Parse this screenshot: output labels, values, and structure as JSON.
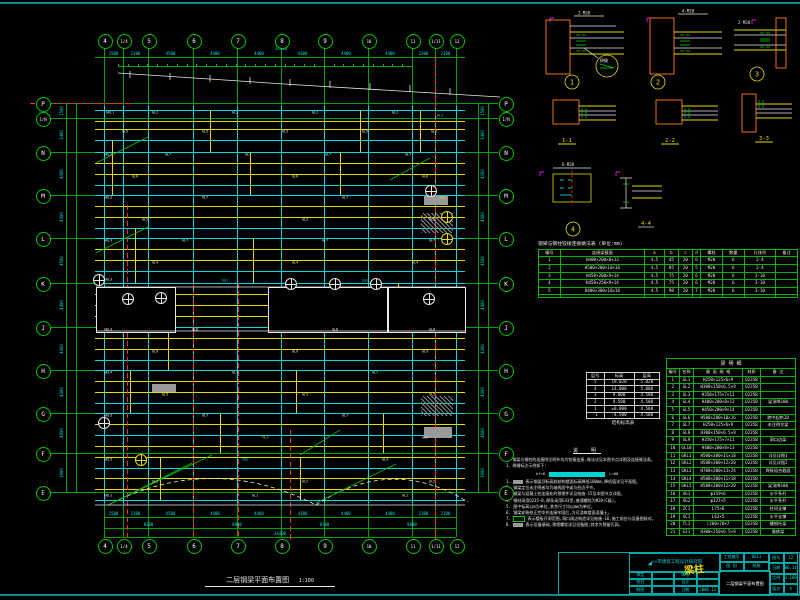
{
  "colors": {
    "green": "#00c000",
    "cyan": "#00dcdc",
    "yellow": "#e8d900",
    "red": "#ff2a2a",
    "white": "#e8e8e8",
    "orange": "#ff7f1f",
    "magenta": "#ff00ff",
    "grey": "#9a9a9a",
    "teal": "#0a8c8c"
  },
  "plan": {
    "title": "二层钢梁平面布置图",
    "scale": "1:100",
    "cols": [
      [
        "4",
        104
      ],
      [
        "1/4",
        123
      ],
      [
        "5",
        148
      ],
      [
        "6",
        193
      ],
      [
        "7",
        237
      ],
      [
        "8",
        281
      ],
      [
        "9",
        324
      ],
      [
        "10",
        368
      ],
      [
        "11",
        412
      ],
      [
        "1/11",
        435
      ],
      [
        "12",
        456
      ]
    ],
    "rows": [
      [
        "P",
        103
      ],
      [
        "1/N",
        118
      ],
      [
        "N",
        152
      ],
      [
        "M",
        195
      ],
      [
        "L",
        238
      ],
      [
        "K",
        283
      ],
      [
        "J",
        327
      ],
      [
        "H",
        370
      ],
      [
        "G",
        413
      ],
      [
        "F",
        453
      ],
      [
        "E",
        492
      ]
    ],
    "bubble_top_y": 40,
    "bubble_bot_y": 545,
    "left_bubble_x": 42,
    "right_bubble_x": 505,
    "beams": [
      [
        110,
        "c"
      ],
      [
        121,
        "y"
      ],
      [
        129,
        "y"
      ],
      [
        140,
        "c"
      ],
      [
        152,
        "c"
      ],
      [
        163,
        "y"
      ],
      [
        174,
        "y"
      ],
      [
        185,
        "c"
      ],
      [
        195,
        "c"
      ],
      [
        206,
        "y"
      ],
      [
        217,
        "y"
      ],
      [
        228,
        "c"
      ],
      [
        238,
        "c"
      ],
      [
        249,
        "y"
      ],
      [
        260,
        "y"
      ],
      [
        271,
        "c"
      ],
      [
        283,
        "c"
      ],
      [
        294,
        "y"
      ],
      [
        305,
        "y"
      ],
      [
        316,
        "y"
      ],
      [
        327,
        "c"
      ],
      [
        338,
        "y"
      ],
      [
        349,
        "y"
      ],
      [
        360,
        "c"
      ],
      [
        370,
        "c"
      ],
      [
        381,
        "y"
      ],
      [
        392,
        "y"
      ],
      [
        403,
        "c"
      ],
      [
        413,
        "c"
      ],
      [
        424,
        "y"
      ],
      [
        435,
        "c"
      ],
      [
        446,
        "y"
      ],
      [
        457,
        "y"
      ],
      [
        468,
        "c"
      ],
      [
        478,
        "y"
      ],
      [
        489,
        "y"
      ],
      [
        500,
        "c"
      ]
    ],
    "yellow_v": [
      [
        112,
        140,
        195
      ],
      [
        135,
        228,
        283
      ],
      [
        168,
        327,
        370
      ],
      [
        210,
        110,
        152
      ],
      [
        253,
        238,
        283
      ],
      [
        296,
        370,
        413
      ],
      [
        340,
        152,
        195
      ],
      [
        383,
        413,
        453
      ],
      [
        398,
        283,
        327
      ],
      [
        420,
        110,
        152
      ],
      [
        160,
        457,
        500
      ],
      [
        220,
        413,
        453
      ],
      [
        300,
        457,
        500
      ],
      [
        360,
        110,
        152
      ],
      [
        250,
        152,
        195
      ],
      [
        130,
        370,
        413
      ]
    ],
    "labels": [
      [
        "GKL1",
        110,
        113,
        "w"
      ],
      [
        "GL2",
        155,
        113,
        "w"
      ],
      [
        "GL2",
        235,
        113,
        "w"
      ],
      [
        "GL2",
        315,
        113,
        "w"
      ],
      [
        "GL2",
        395,
        113,
        "w"
      ],
      [
        "GL3",
        440,
        116,
        "c"
      ],
      [
        "GL5",
        125,
        132,
        "w"
      ],
      [
        "GL5",
        205,
        132,
        "w"
      ],
      [
        "GL5",
        285,
        132,
        "w"
      ],
      [
        "GL5",
        365,
        132,
        "w"
      ],
      [
        "GL3",
        434,
        132,
        "w"
      ],
      [
        "GKL2",
        108,
        155,
        "w"
      ],
      [
        "GL7",
        168,
        155,
        "w"
      ],
      [
        "GL7",
        248,
        155,
        "w"
      ],
      [
        "GL7",
        328,
        155,
        "w"
      ],
      [
        "GL7",
        408,
        155,
        "w"
      ],
      [
        "GL6",
        135,
        177,
        "w"
      ],
      [
        "GL6",
        295,
        177,
        "w"
      ],
      [
        "GL6",
        425,
        177,
        "w"
      ],
      [
        "GKL2",
        108,
        198,
        "w"
      ],
      [
        "GL7",
        205,
        198,
        "w"
      ],
      [
        "GL7",
        345,
        198,
        "w"
      ],
      [
        "B1",
        443,
        198,
        "y"
      ],
      [
        "GL5",
        145,
        220,
        "w"
      ],
      [
        "GL5",
        305,
        220,
        "w"
      ],
      [
        "GL5",
        432,
        220,
        "w"
      ],
      [
        "GKL3",
        108,
        241,
        "w"
      ],
      [
        "GL7",
        185,
        241,
        "w"
      ],
      [
        "GL7",
        325,
        241,
        "w"
      ],
      [
        "GL7",
        432,
        241,
        "w"
      ],
      [
        "GL4",
        155,
        263,
        "w"
      ],
      [
        "GL4",
        295,
        263,
        "w"
      ],
      [
        "GL4",
        415,
        263,
        "w"
      ],
      [
        "GKL3",
        108,
        280,
        "w"
      ],
      [
        "XG1",
        225,
        281,
        "c"
      ],
      [
        "XG1",
        365,
        281,
        "c"
      ],
      [
        "GKL4",
        108,
        330,
        "w"
      ],
      [
        "GL8",
        195,
        330,
        "w"
      ],
      [
        "GL8",
        335,
        330,
        "w"
      ],
      [
        "GL8",
        432,
        330,
        "w"
      ],
      [
        "GL9",
        155,
        352,
        "w"
      ],
      [
        "GL9",
        295,
        352,
        "w"
      ],
      [
        "GL9",
        425,
        352,
        "w"
      ],
      [
        "GKL4",
        108,
        373,
        "w"
      ],
      [
        "GL7",
        235,
        373,
        "w"
      ],
      [
        "GL7",
        375,
        373,
        "w"
      ],
      [
        "GL5",
        165,
        395,
        "w"
      ],
      [
        "GL5",
        305,
        395,
        "w"
      ],
      [
        "GL5",
        432,
        395,
        "w"
      ],
      [
        "GKL5",
        108,
        416,
        "w"
      ],
      [
        "GL7",
        205,
        416,
        "w"
      ],
      [
        "GL7",
        345,
        416,
        "w"
      ],
      [
        "TL1",
        265,
        438,
        "y"
      ],
      [
        "GJ1",
        425,
        438,
        "w"
      ],
      [
        "GKL5",
        108,
        460,
        "w"
      ],
      [
        "XG2",
        245,
        460,
        "c"
      ],
      [
        "GL3",
        385,
        460,
        "w"
      ],
      [
        "GL2",
        155,
        482,
        "w"
      ],
      [
        "GL2",
        305,
        482,
        "w"
      ],
      [
        "GL2",
        432,
        482,
        "w"
      ],
      [
        "GKL1",
        108,
        496,
        "w"
      ],
      [
        "GL1",
        255,
        496,
        "w"
      ],
      [
        "GL1",
        405,
        496,
        "w"
      ]
    ],
    "dims_top": [
      "1500",
      "2100",
      "4500",
      "4400",
      "4400",
      "4300",
      "4400",
      "4400",
      "2300",
      "2100"
    ],
    "total_top": "34400",
    "dims_bottom": [
      "1500",
      "2100",
      "4500",
      "4400",
      "4400",
      "4300",
      "4400",
      "4400",
      "2300",
      "2100"
    ],
    "dims_bottom2": [
      [
        "8100",
        104,
        193
      ],
      [
        "8800",
        193,
        281
      ],
      [
        "8700",
        281,
        368
      ],
      [
        "8800",
        368,
        456
      ]
    ],
    "total_bottom": "34400",
    "dims_left": [
      "1500",
      "3400",
      "4300",
      "4300",
      "4500",
      "4400",
      "4300",
      "4300",
      "4000",
      "3900"
    ],
    "dims_right": [
      "1500",
      "3400",
      "4300",
      "4300",
      "4500",
      "4400",
      "4300",
      "4300",
      "4000",
      "3900"
    ],
    "dim_lines_h": [
      [
        57,
        95,
        465
      ],
      [
        66,
        118,
        412
      ],
      [
        517,
        104,
        456
      ],
      [
        528,
        104,
        456
      ],
      [
        537,
        104,
        456
      ]
    ],
    "dim_lines_v": [
      [
        66,
        103,
        492
      ],
      [
        76,
        103,
        492
      ],
      [
        478,
        103,
        492
      ],
      [
        488,
        103,
        492
      ]
    ],
    "tick_row": {
      "y": 64,
      "x1": 118,
      "x2": 412,
      "step": 9.8
    },
    "red_v": [
      [
        127,
        205,
        540
      ],
      [
        193,
        283,
        540
      ],
      [
        238,
        283,
        540
      ],
      [
        290,
        430,
        540
      ],
      [
        435,
        55,
        540
      ]
    ],
    "red_h": [
      [
        103,
        30,
        133
      ]
    ],
    "openings": [
      [
        96,
        287,
        78,
        44
      ],
      [
        268,
        287,
        118,
        44
      ],
      [
        388,
        287,
        76,
        44
      ]
    ],
    "grey": [
      [
        424,
        196,
        24,
        9
      ],
      [
        424,
        427,
        28,
        11
      ],
      [
        152,
        384,
        24,
        8
      ]
    ],
    "hatch": [
      [
        421,
        213,
        32,
        20
      ],
      [
        421,
        396,
        32,
        20
      ]
    ],
    "symbols": [
      [
        98,
        279,
        "w"
      ],
      [
        127,
        298,
        "w"
      ],
      [
        160,
        297,
        "w"
      ],
      [
        290,
        283,
        "w"
      ],
      [
        334,
        283,
        "w"
      ],
      [
        375,
        283,
        "w"
      ],
      [
        428,
        298,
        "w"
      ],
      [
        430,
        190,
        "w"
      ],
      [
        446,
        216,
        "y"
      ],
      [
        446,
        238,
        "y"
      ],
      [
        103,
        422,
        "w"
      ],
      [
        140,
        459,
        "y"
      ]
    ],
    "paths": [
      [
        "M118,73 L300,85 L500,97",
        "w",
        ""
      ],
      [
        "M130,71 L130,78 M170,73 L170,80 M210,75 L210,82 M250,77 L250,84 M290,79 L290,86 M330,81 L330,88 M370,83 L370,90 M410,85 L410,92 M450,88 L450,95",
        "w",
        ""
      ],
      [
        "M108,505 Q212,452 316,505",
        "w",
        "4,3"
      ],
      [
        "M316,505 Q392,455 468,502",
        "w",
        "4,3"
      ],
      [
        "M112,503 L192,463",
        "g",
        ""
      ],
      [
        "M212,455 L108,505",
        "g",
        ""
      ],
      [
        "M316,503 L396,464",
        "g",
        ""
      ],
      [
        "M96,287 L465,287",
        "w",
        ""
      ],
      [
        "M96,331 L465,331",
        "w",
        ""
      ],
      [
        "M95,505 L465,505",
        "w",
        ""
      ],
      [
        "M96,163 L148,137",
        "g",
        ""
      ],
      [
        "M96,253 L148,227",
        "g",
        ""
      ],
      [
        "M390,180 L430,158",
        "g",
        ""
      ],
      [
        "M300,455 L340,430",
        "g",
        ""
      ]
    ]
  },
  "details": {
    "d1": {
      "num": "1",
      "sec": "1-1",
      "ann1": "2-M20",
      "ann2": "PL-10"
    },
    "d2": {
      "num": "2",
      "sec": "2-2",
      "ann1": "4-M20",
      "ann2": "PL-12"
    },
    "d3": {
      "num": "3",
      "sec": "3-3",
      "ann1": "2-M20",
      "ann2": "PL-10"
    },
    "d4": {
      "num": "4",
      "sec": "4-4",
      "ann1": "6-M20",
      "ann2": "PL-12"
    },
    "callout": "焊缝"
  },
  "conn_table": {
    "title": "钢梁与钢柱铰接连接做法表 (单位:mm)",
    "headers": [
      "编号",
      "连接梁截面",
      "a",
      "b",
      "c",
      "d",
      "螺栓",
      "数量",
      "孔排列",
      "备注"
    ],
    "rows": [
      [
        "1",
        "H400×200×8×13",
        "4.5",
        "45",
        "20",
        "6",
        "M20",
        "6",
        "2-4",
        ""
      ],
      [
        "2",
        "H500×200×10×16",
        "4.5",
        "85",
        "20",
        "5",
        "M20",
        "6",
        "2-4",
        ""
      ],
      [
        "3",
        "H450×200×9×14",
        "4.5",
        "75",
        "20",
        "6",
        "M20",
        "6",
        "3-10",
        ""
      ],
      [
        "4",
        "H450×250×9×14",
        "4.5",
        "75",
        "20",
        "6",
        "M20",
        "6",
        "3-10",
        ""
      ],
      [
        "5",
        "H400×300×10×16",
        "4.5",
        "90",
        "20",
        "7",
        "M20",
        "6",
        "3-10",
        ""
      ],
      [
        "",
        "",
        "",
        "",
        "",
        "",
        "",
        "",
        "",
        ""
      ]
    ]
  },
  "level_table": {
    "headers": [
      "层号",
      "标高",
      "层高"
    ],
    "rows": [
      [
        "5",
        "19.020",
        "5.020"
      ],
      [
        "4",
        "14.000",
        "5.000"
      ],
      [
        "3",
        "9.000",
        "4.500"
      ],
      [
        "2",
        "4.500",
        "4.500"
      ],
      [
        "1",
        "±0.000",
        "4.500"
      ],
      [
        "-1",
        "-4.500",
        "4.500"
      ]
    ],
    "caption": "结构标高表"
  },
  "member_table": {
    "title": "梁  明  细",
    "headers": [
      "编号",
      "名称",
      "截 面 规 格",
      "材质",
      "备 注"
    ],
    "rows": [
      [
        "1",
        "GL1",
        "H250×125×6×9",
        "Q235B",
        ""
      ],
      [
        "2",
        "GL2",
        "H300×150×6.5×9",
        "Q235B",
        ""
      ],
      [
        "3",
        "GL3",
        "H350×175×7×11",
        "Q235B",
        ""
      ],
      [
        "4",
        "GL4",
        "H400×200×8×13",
        "Q235B",
        "梁顶降100"
      ],
      [
        "5",
        "GL5",
        "H450×200×9×14",
        "Q235B",
        ""
      ],
      [
        "6",
        "GL6",
        "H500×200×10×16",
        "Q235B",
        "跨中起拱20"
      ],
      [
        "7",
        "GL7",
        "H250×125×6×9",
        "Q235B",
        "未注明次梁"
      ],
      [
        "8",
        "GL8",
        "H300×150×6.5×9",
        "Q235B",
        ""
      ],
      [
        "9",
        "GL9",
        "H350×175×7×11",
        "Q235B",
        "洞口边梁"
      ],
      [
        "10",
        "GL10",
        "H400×200×8×13",
        "Q235B",
        ""
      ],
      [
        "11",
        "GKL1",
        "H500×300×11×18",
        "Q235B",
        "详见详图1"
      ],
      [
        "12",
        "GKL2",
        "H588×300×12×20",
        "Q235B",
        "详见详图2"
      ],
      [
        "13",
        "GKL3",
        "H700×300×13×24",
        "Q235B",
        "焊接组合截面"
      ],
      [
        "14",
        "GKL4",
        "H500×300×11×18",
        "Q235B",
        ""
      ],
      [
        "15",
        "GKL5",
        "H588×300×12×20",
        "Q235B",
        "梁顶降100"
      ],
      [
        "16",
        "XG1",
        "φ159×6",
        "Q235B",
        "水平系杆"
      ],
      [
        "17",
        "XG2",
        "φ127×5",
        "Q235B",
        "水平系杆"
      ],
      [
        "18",
        "ZC1",
        "L75×6",
        "Q235B",
        "柱间支撑"
      ],
      [
        "19",
        "SC1",
        "L63×5",
        "Q235B",
        "水平支撑"
      ],
      [
        "20",
        "TL1",
        "[200×70×7",
        "Q235B",
        "槽钢托梁"
      ],
      [
        "21",
        "GJ1",
        "H300×150×6.5×9",
        "Q235B",
        "悬挑梁"
      ]
    ]
  },
  "notes": {
    "header": "说  明",
    "intro": [
      "1、钢梁与钢柱的连接除注明外均为铰接连接,做法详见本图节点详图及连接做法表。",
      "2、焊缝标注示例如下:"
    ],
    "weld_left": "hf=6",
    "weld_right": "L=60",
    "items": [
      {
        "n": "1.",
        "box": "grey",
        "t": "表示钢梁顶标高较结构楼面标高降低100mm,降低值详见平面图。"
      },
      {
        "n": "2.",
        "box": "",
        "t": "钢梁定位未注明者均为轴线居中或与柱边平齐。"
      },
      {
        "n": "3.",
        "box": "",
        "t": "钢梁与混凝土柱连接处的预埋件详见结施-15及本图节点详图。"
      },
      {
        "n": "4.",
        "box": "",
        "t": "钢材采用Q235-B,焊条采用E43型,普通螺栓为M20(C级)。"
      },
      {
        "n": "5.",
        "box": "",
        "t": "图中标高以m为单位,其余尺寸均以mm为单位。"
      },
      {
        "n": "6.",
        "box": "",
        "t": "钢梁安装校正完毕并连接牢固后,方可浇筑楼面混凝土。"
      },
      {
        "n": "7.",
        "box": "green",
        "t": "表示楼板开洞范围,洞口周边构造详见结施-16,施工前应与设备图核对。"
      },
      {
        "n": "8.",
        "box": "grey",
        "t": "表示设备基础,预埋螺栓详见设备图;其余为预留孔洞。"
      }
    ]
  },
  "titleblock": {
    "company": "××市建筑工程设计研究院",
    "stamp": "梁柱",
    "sheet_title": "二层钢梁平面布置图",
    "sig_rows": [
      [
        "审定",
        "",
        "审核",
        ""
      ],
      [
        "校对",
        "",
        "设计",
        ""
      ],
      [
        "制图",
        "",
        "日期",
        "2006.11"
      ]
    ],
    "top_cells": [
      [
        "工程编号",
        "0611"
      ],
      [
        "图 别",
        "结施"
      ]
    ],
    "right_cells": [
      [
        "图号",
        "12"
      ],
      [
        "日期",
        "06.11"
      ],
      [
        "比例",
        "1:100"
      ],
      [
        "版次",
        "A"
      ]
    ]
  }
}
